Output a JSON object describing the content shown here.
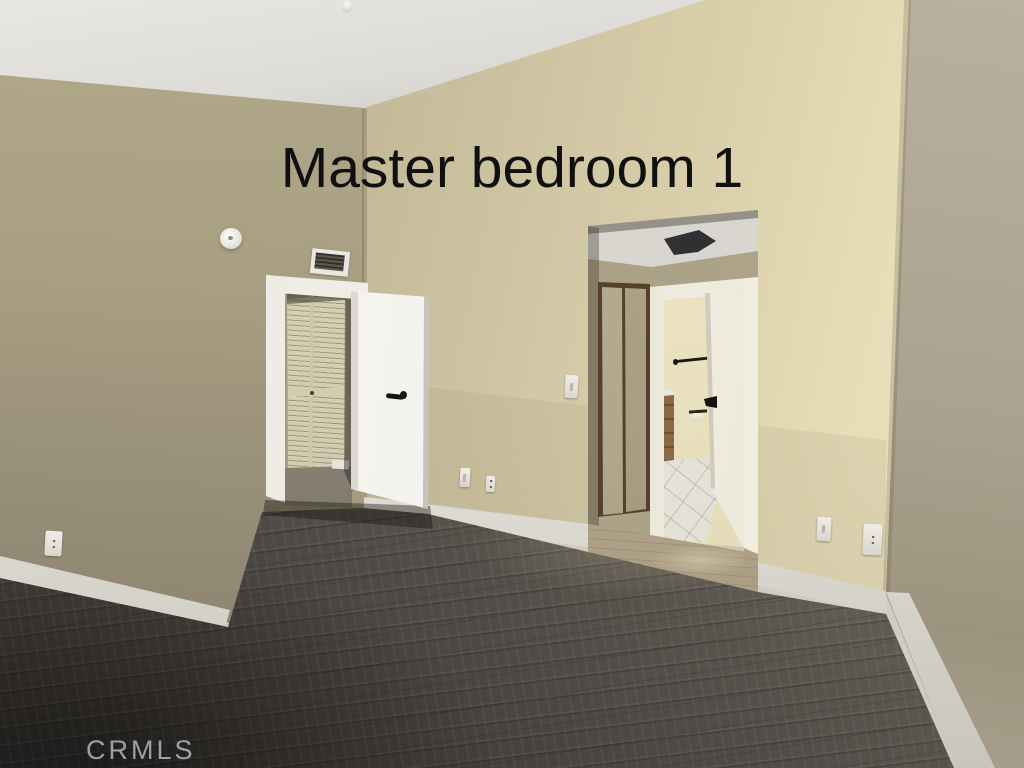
{
  "photo": {
    "caption": "Master bedroom 1",
    "watermark": "CRMLS"
  },
  "palette": {
    "ceiling": "#d6d4cf",
    "left_wall": "#a89e82",
    "back_wall": "#d6cca8",
    "back_wall_highlight": "#ece3c1",
    "right_wall": "#aba28f",
    "trim_and_doors": "#f2f1ec",
    "louvered_closet_door": "#d2cbaf",
    "closet_slider_frame": "#55412b",
    "floor_dark": "#2e2b28",
    "floor_light": "#968e81",
    "alcove_floor": "#b0a289",
    "bathroom_tile": "#e6e3da",
    "door_hardware": "#17140f",
    "caption_color": "#101010",
    "watermark_color": "#b9c0ca"
  },
  "scene": {
    "room": "empty master bedroom",
    "objects": [
      "smoke-detector",
      "wall-air-vent",
      "fire-sprinkler",
      "open-interior-door",
      "louvered-closet-door",
      "sliding-closet-door",
      "bathroom-doorway",
      "bathroom-door",
      "towel-bar",
      "toilet-paper-holder",
      "bathroom-vanity",
      "tile-floor",
      "wood-laminate-floor",
      "baseboard",
      "light-switch",
      "power-outlet",
      "phone-jack",
      "ceiling-exhaust-vent"
    ]
  }
}
